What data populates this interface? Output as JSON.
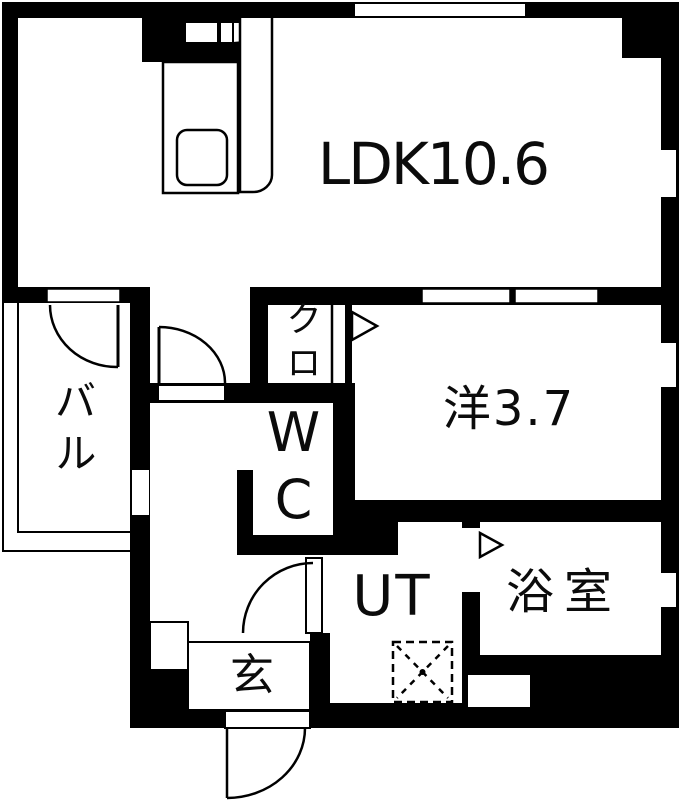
{
  "page": {
    "width_px": 679,
    "height_px": 800,
    "background": "#ffffff"
  },
  "floor_plan": {
    "kind": "Japanese 1LDK apartment floor plan",
    "colors": {
      "walls": "#000000",
      "floor": "#ffffff",
      "lines": "#111111"
    },
    "labels": {
      "ldk": "LDK10.6",
      "western_room": "洋3.7",
      "balcony": "バル",
      "closet": "クロ",
      "toilet": "WC",
      "utility": "UT",
      "bathroom": "浴室",
      "entrance": "玄"
    },
    "symbols": {
      "door_swing": "quarter-circle arc with leaf line",
      "opening_direction": "outlined triangle",
      "washing_machine_space": "dashed square with dashed X and center dot",
      "kitchen_sink": "rounded rectangle in kitchen counter",
      "window": "white gap in black wall"
    }
  }
}
